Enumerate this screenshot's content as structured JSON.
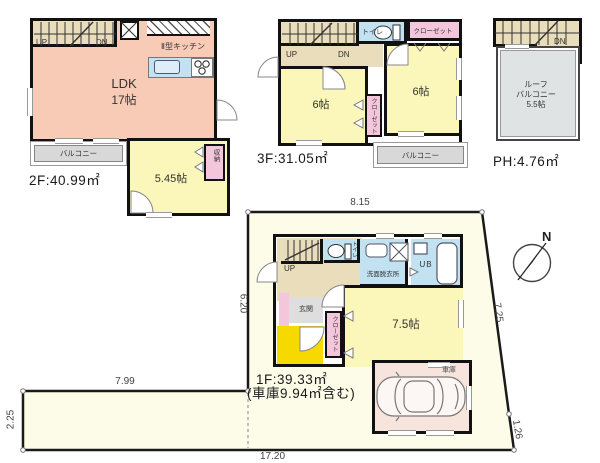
{
  "floor2": {
    "title": "2F:40.99㎡",
    "ldk_label": "LDK",
    "ldk_size": "17帖",
    "kitchen_label": "Ⅱ型キッチン",
    "room_label": "5.45帖",
    "balcony_label": "バルコニー",
    "storage_label": "収納",
    "up": "UP",
    "dn": "DN"
  },
  "floor3": {
    "title": "3F:31.05㎡",
    "room_a_label": "6帖",
    "room_b_label": "6帖",
    "toilet_label": "トイレ",
    "closet_top_label": "クローゼット",
    "closet_mid_label": "クローゼット",
    "balcony_label": "バルコニー",
    "up": "UP",
    "dn": "DN"
  },
  "floor_ph": {
    "title": "PH:4.76㎡",
    "roof_balcony_line1": "ルーフ",
    "roof_balcony_line2": "バルコニー",
    "roof_balcony_size": "5.5帖",
    "dn": "DN"
  },
  "floor1": {
    "title": "1F:39.33㎡",
    "subtitle": "(車庫9.94㎡含む)",
    "room_label": "7.5帖",
    "entrance_label": "玄関",
    "washroom_label": "洗面脱衣所",
    "bath_label": "UB",
    "toilet_label": "トイレ",
    "closet_label": "クローゼット",
    "garage_label": "車庫",
    "up": "UP"
  },
  "site": {
    "dim_top": "8.15",
    "dim_right": "7.25",
    "dim_right_bottom": "1.26",
    "dim_bottom": "17.20",
    "dim_strip_top": "7.99",
    "dim_strip_left": "2.25",
    "dim_left": "6.20"
  },
  "compass": {
    "north": "N"
  }
}
